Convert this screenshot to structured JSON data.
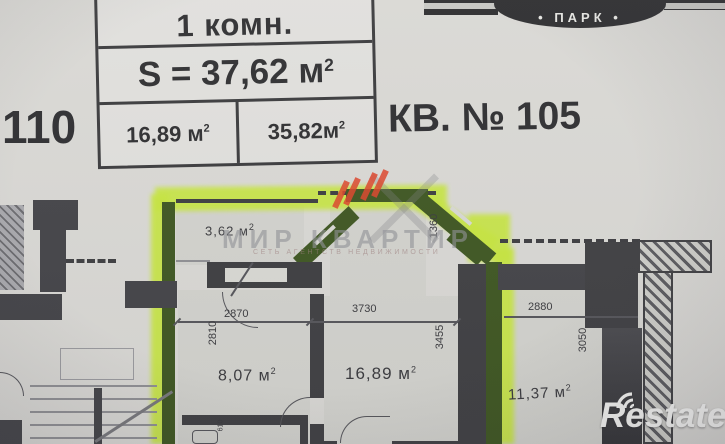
{
  "sup2": "2",
  "header": {
    "left_apartment_number": "110",
    "apartment_label": "КВ. № 105",
    "banner_text": "• ПАРК •"
  },
  "info_table": {
    "room_type": "1 комн.",
    "total_area": "S = 37,62 м",
    "area_cell_1": "16,89 м",
    "area_cell_2": "35,82м"
  },
  "plan": {
    "rooms": [
      {
        "id": "balcony",
        "area": "3,62 м"
      },
      {
        "id": "room-small",
        "area": "8,07 м"
      },
      {
        "id": "room-main",
        "area": "16,89 м"
      },
      {
        "id": "room-neighbor",
        "area": "11,37 м"
      }
    ],
    "dimensions": {
      "top_small": "2870",
      "top_main": "3730",
      "top_neighbor": "2880",
      "left_small": "2810",
      "right_main": "3455",
      "bay_right": "1360",
      "right_neighbor": "3050",
      "bath": "610"
    }
  },
  "watermarks": {
    "agency_name": "МИР КВАРТИР",
    "agency_tagline": "СЕТЬ АГЕНТСТВ НЕДВИЖИМОСТИ",
    "photo_logo": "Restate"
  },
  "colors": {
    "highlight": "#c7e63f",
    "wall": "#434347",
    "wall_highlighted": "#3e5621",
    "paper": "#d9d8d4",
    "banner": "#2c2c2e",
    "slash_red": "#dd4429"
  }
}
